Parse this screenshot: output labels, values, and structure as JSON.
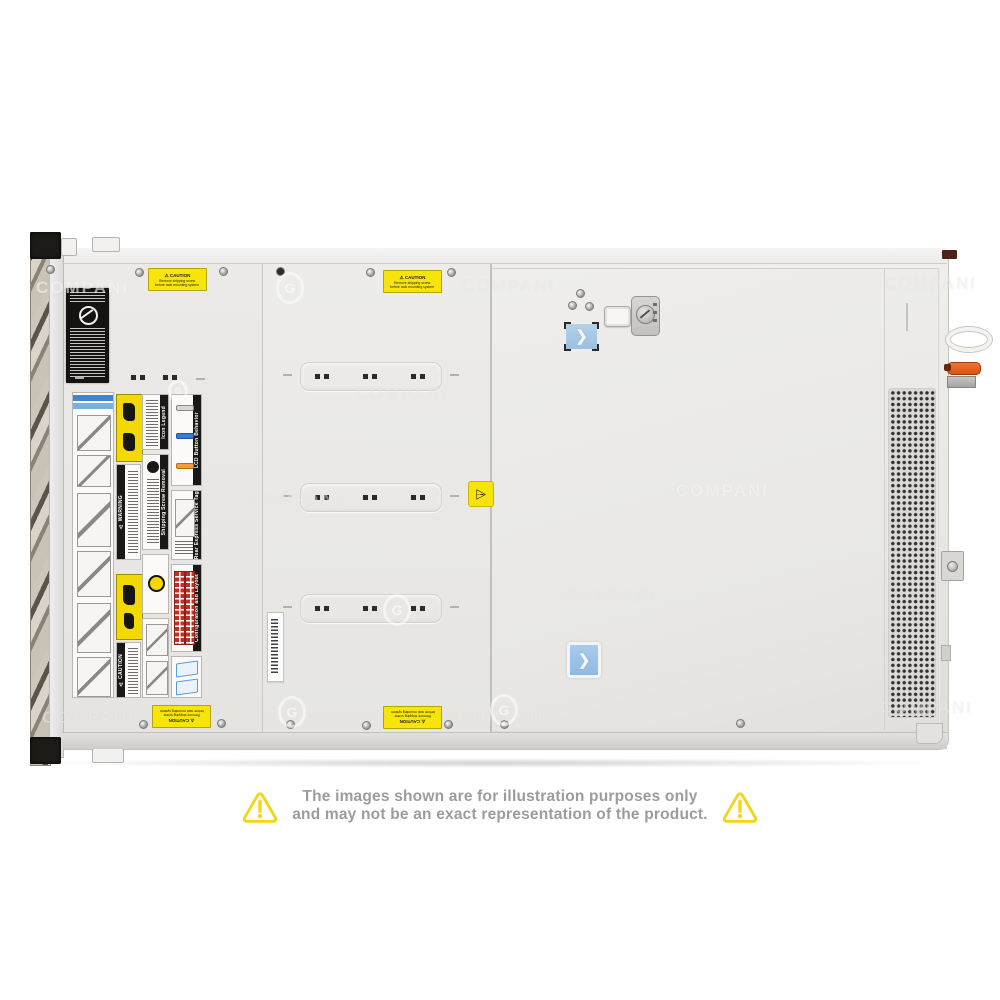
{
  "watermark": {
    "text": "COMPANI",
    "logo_letter": "G"
  },
  "stickers": {
    "caution_title": "⚠ CAUTION",
    "caution_line1": "Remove shipping screw",
    "caution_line2": "before rack mounting system",
    "seam_warning_icon": "⚠"
  },
  "labels": {
    "icon_legend": "Icon Legend",
    "lcd_behavior": "LCD Button Behavior",
    "service_tag": "Rear Express Service Tag",
    "shipping_screw": "Shipping Screw Removal",
    "config_layout": "Configuration and Layout",
    "warning": "⚠ WARNING",
    "caution": "⚠ CAUTION"
  },
  "icons": {
    "chevron": "❯"
  },
  "disclaimer": {
    "line1": "The images shown are for illustration purposes only",
    "line2": "and may not be an exact representation of the product."
  },
  "colors": {
    "latch_blue": "#9cc0e2",
    "latch_orange": "#e35f1d",
    "sticker_yellow": "#f6e40a",
    "warning_outline_yellow": "#f4d512",
    "disclaimer_text": "#9c9c9c",
    "chassis_gray": "#e8e7e4"
  }
}
